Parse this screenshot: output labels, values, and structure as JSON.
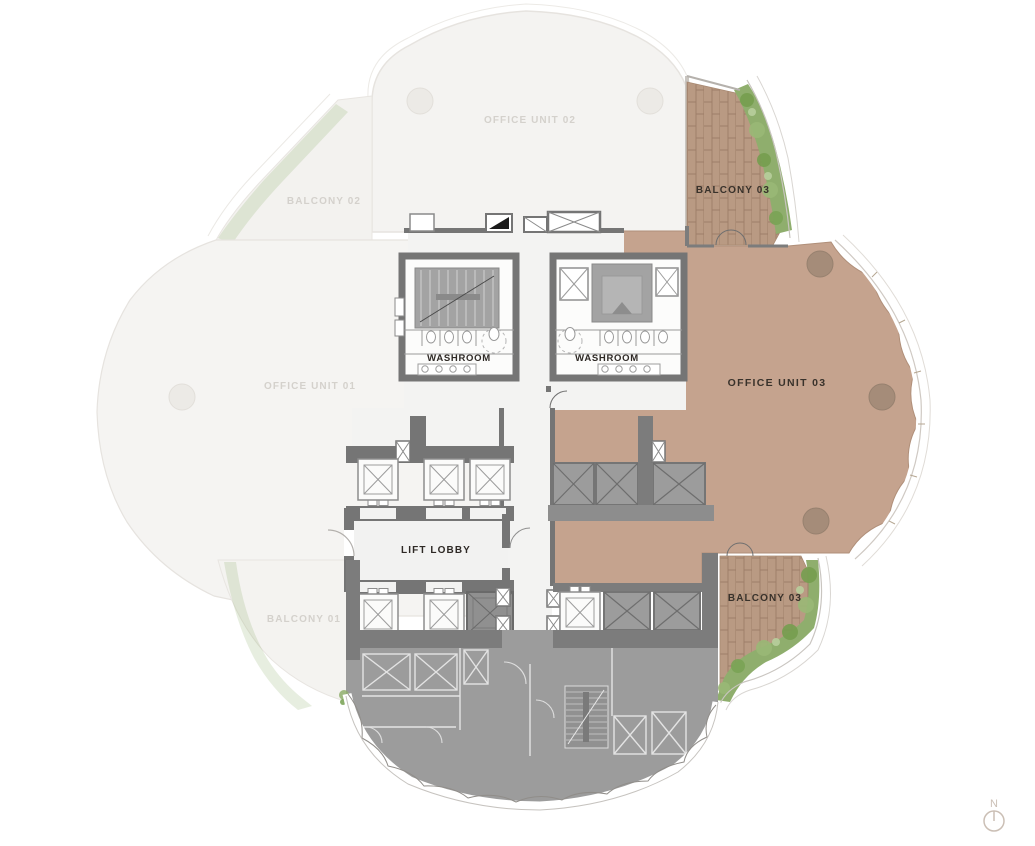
{
  "plan": {
    "labels": {
      "office_unit_01": "OFFICE UNIT 01",
      "office_unit_02": "OFFICE UNIT 02",
      "office_unit_03": "OFFICE UNIT 03",
      "balcony_01": "BALCONY 01",
      "balcony_02": "BALCONY 02",
      "balcony_03_upper": "BALCONY 03",
      "balcony_03_lower": "BALCONY 03",
      "washroom_left": "WASHROOM",
      "washroom_right": "WASHROOM",
      "lift_lobby": "LIFT LOBBY"
    },
    "compass": {
      "north": "N"
    },
    "colors": {
      "unit_highlight": "#c5a38e",
      "balcony_tile": "#b99a83",
      "landscape_green": "#8fae6d",
      "landscape_green_dark": "#76a050",
      "core_wall": "#757575",
      "service_zone": "#9c9c9c",
      "column": "#a58c79",
      "faded_label": "#d4d1cc",
      "dark_label": "#39322b",
      "compass": "#cbbfb5"
    }
  }
}
